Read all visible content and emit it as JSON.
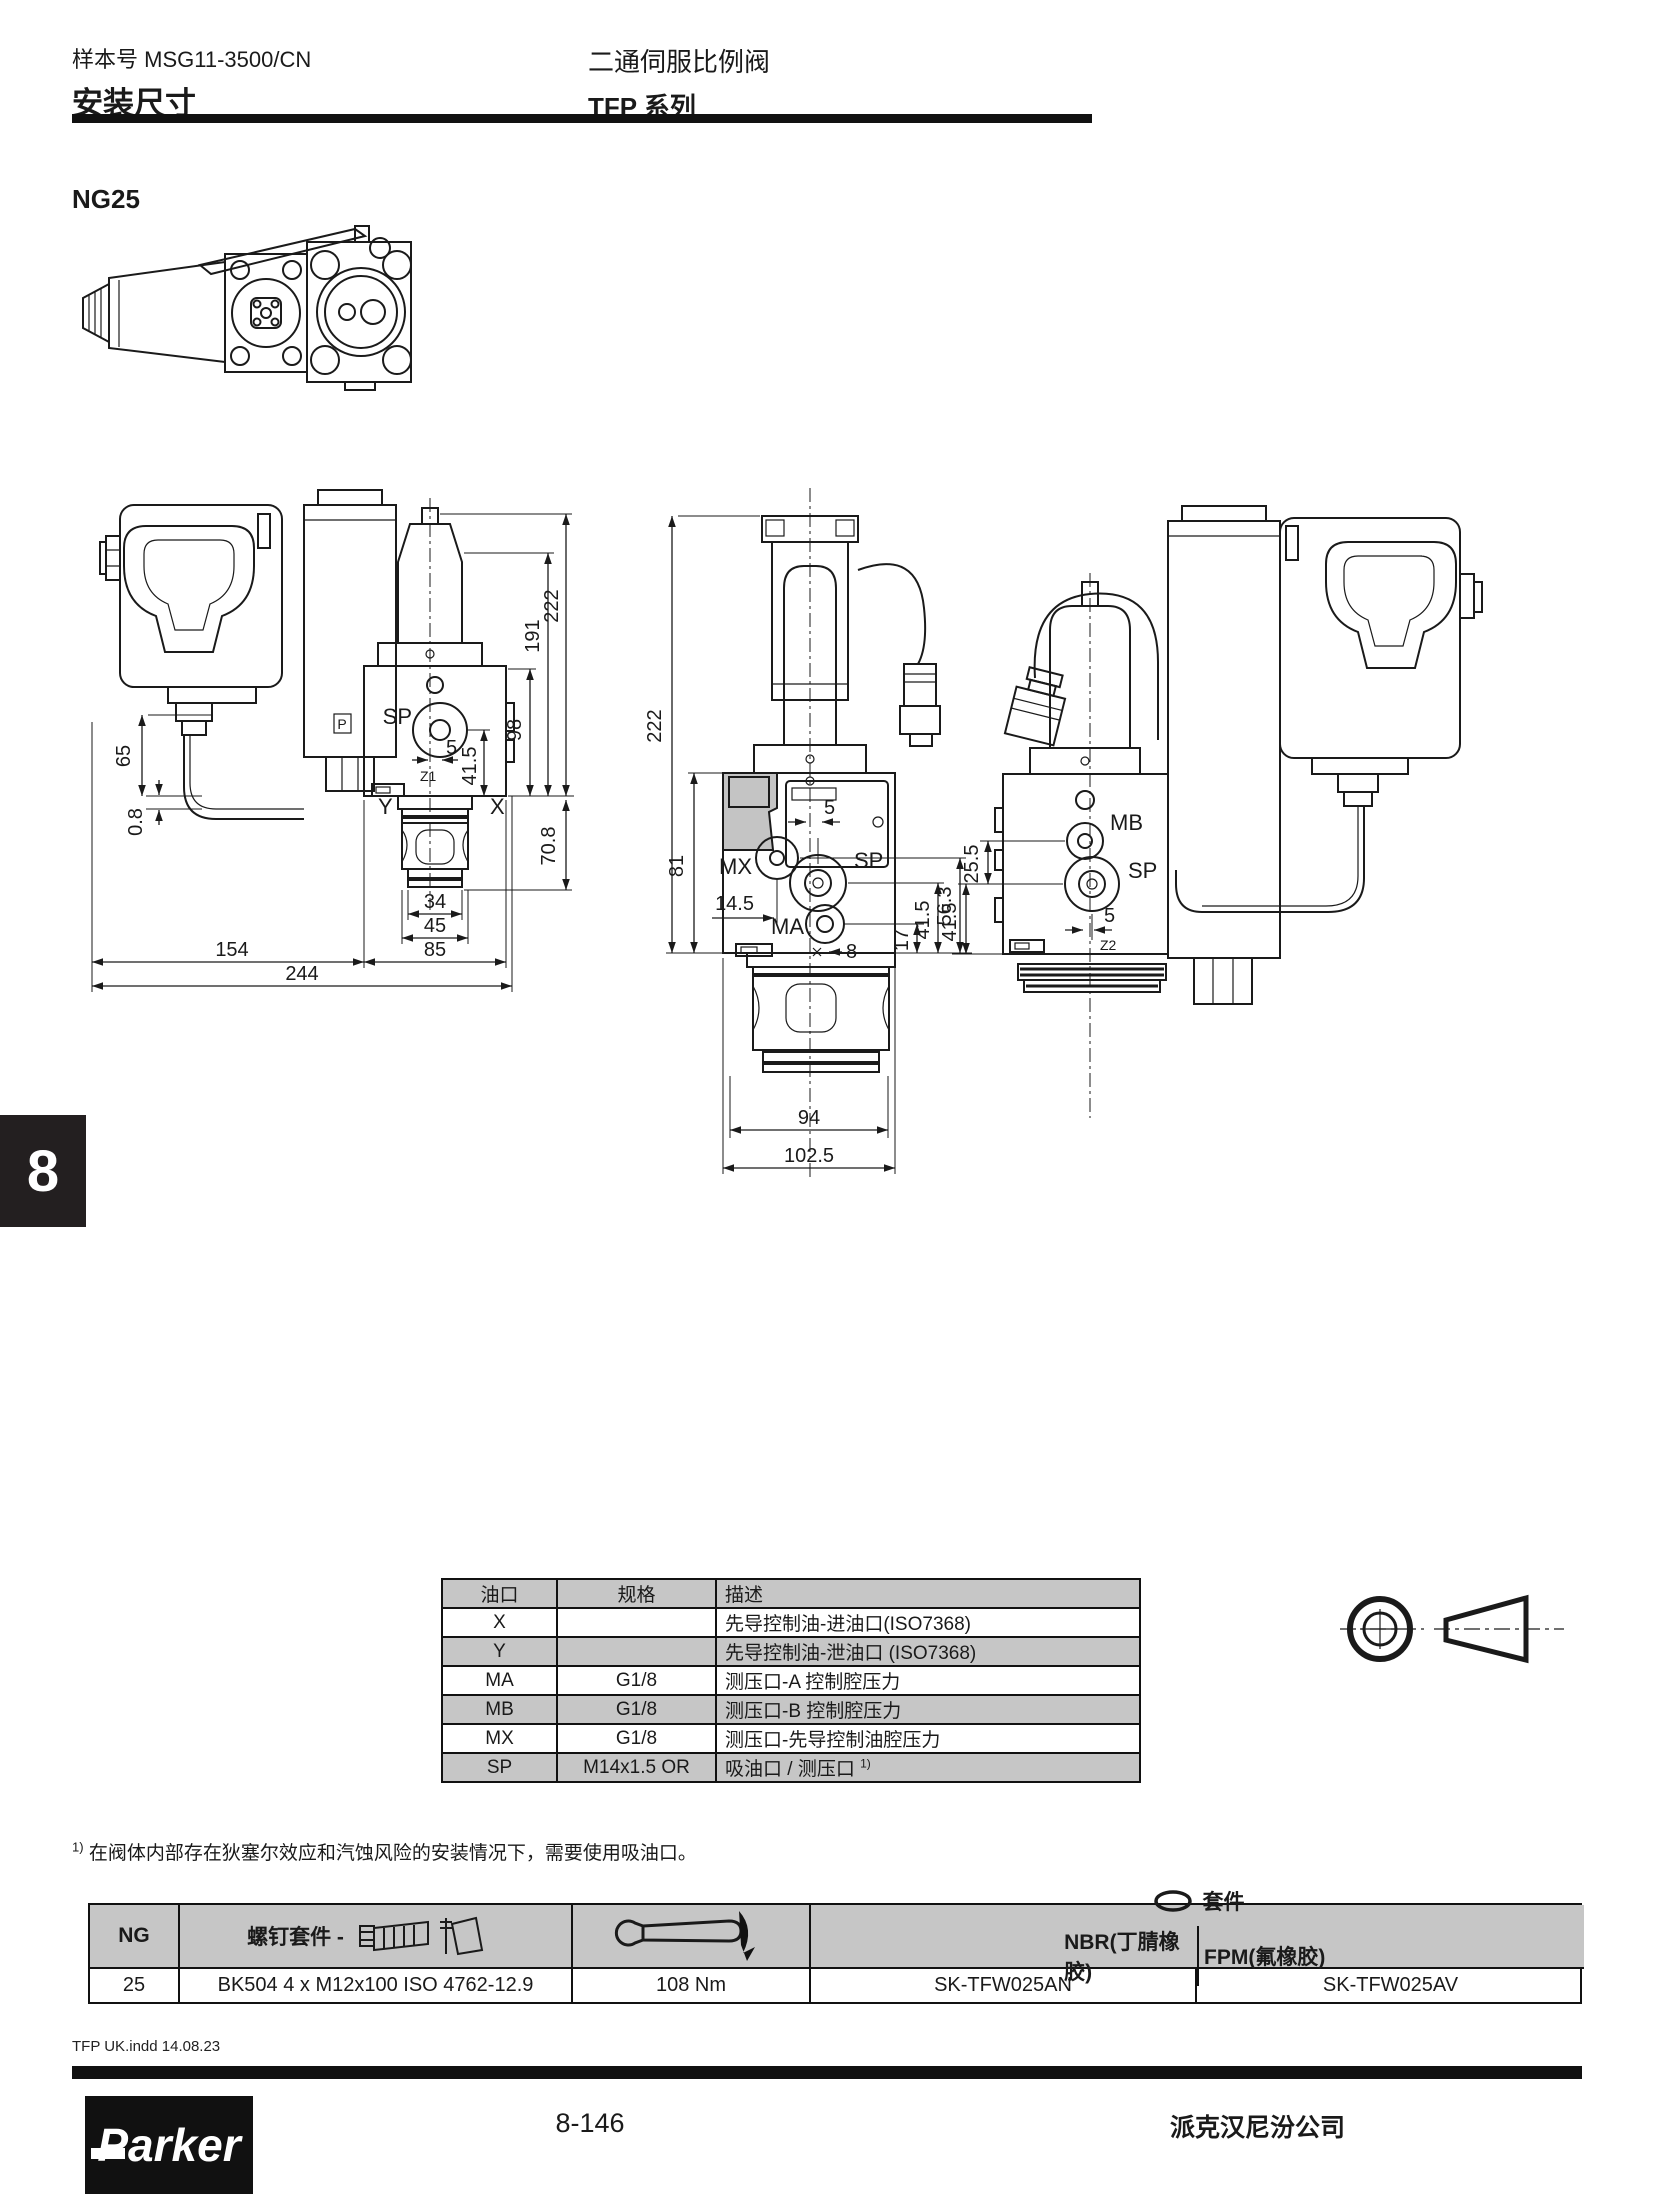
{
  "page": {
    "catalog_label": "样本号 MSG11-3500/CN",
    "section_title": "安装尺寸",
    "product_line1": "二通伺服比例阀",
    "product_line2": "TFP 系列",
    "size_heading": "NG25",
    "tab_number": "8",
    "page_number": "8-146",
    "company_name": "派克汉尼汾公司",
    "imprint": "TFP UK.indd  14.08.23",
    "logo_text": "Parker"
  },
  "colors": {
    "table_row_gray": "#c6c6c6",
    "line_black": "#1a1a1a",
    "bar_black": "#111111"
  },
  "ports_table": {
    "headers": [
      "油口",
      "规格",
      "描述"
    ],
    "rows": [
      {
        "port": "X",
        "size": "",
        "desc": "先导控制油-进油口(ISO7368)"
      },
      {
        "port": "Y",
        "size": "",
        "desc": "先导控制油-泄油口 (ISO7368)"
      },
      {
        "port": "MA",
        "size": "G1/8",
        "desc": "测压口-A 控制腔压力"
      },
      {
        "port": "MB",
        "size": "G1/8",
        "desc": "测压口-B 控制腔压力"
      },
      {
        "port": "MX",
        "size": "G1/8",
        "desc": "测压口-先导控制油腔压力"
      },
      {
        "port": "SP",
        "size": "M14x1.5 OR",
        "desc": "吸油口 / 测压口 ",
        "sup": "1)"
      }
    ]
  },
  "footnote": {
    "marker": "1)",
    "text": "在阀体内部存在狄塞尔效应和汽蚀风险的安装情况下，需要使用吸油口。"
  },
  "kits_table": {
    "headers": {
      "ng": "NG",
      "bolt_kit": "螺钉套件 -",
      "seal_kit": "套件",
      "nbr": "NBR(丁腈橡胶)",
      "fpm": "FPM(氟橡胶)"
    },
    "row": {
      "ng": "25",
      "bolt_kit": "BK504  4 x M12x100  ISO 4762-12.9",
      "torque": "108 Nm",
      "nbr": "SK-TFW025AN",
      "fpm": "SK-TFW025AV"
    }
  },
  "drawing": {
    "view_a": {
      "sp": "SP",
      "y": "Y",
      "x": "X",
      "z1": "Z1",
      "p": "P",
      "d222": "222",
      "d191": "191",
      "d98": "98",
      "d65": "65",
      "d08": "0.8",
      "d415": "41.5",
      "d5": "5",
      "d708": "70.8",
      "d34": "34",
      "d45": "45",
      "d85": "85",
      "d154": "154",
      "d244": "244"
    },
    "view_b": {
      "mx": "MX",
      "sp": "SP",
      "ma": "MA",
      "d222": "222",
      "d81": "81",
      "d5": "5",
      "d145": "14.5",
      "d8": "8",
      "d17": "17",
      "d415": "41.5",
      "d563": "56.3",
      "d94": "94",
      "d1025": "102.5"
    },
    "view_c": {
      "mb": "MB",
      "sp": "SP",
      "z2": "Z2",
      "d255": "25.5",
      "d415": "41.5",
      "d5": "5"
    }
  }
}
